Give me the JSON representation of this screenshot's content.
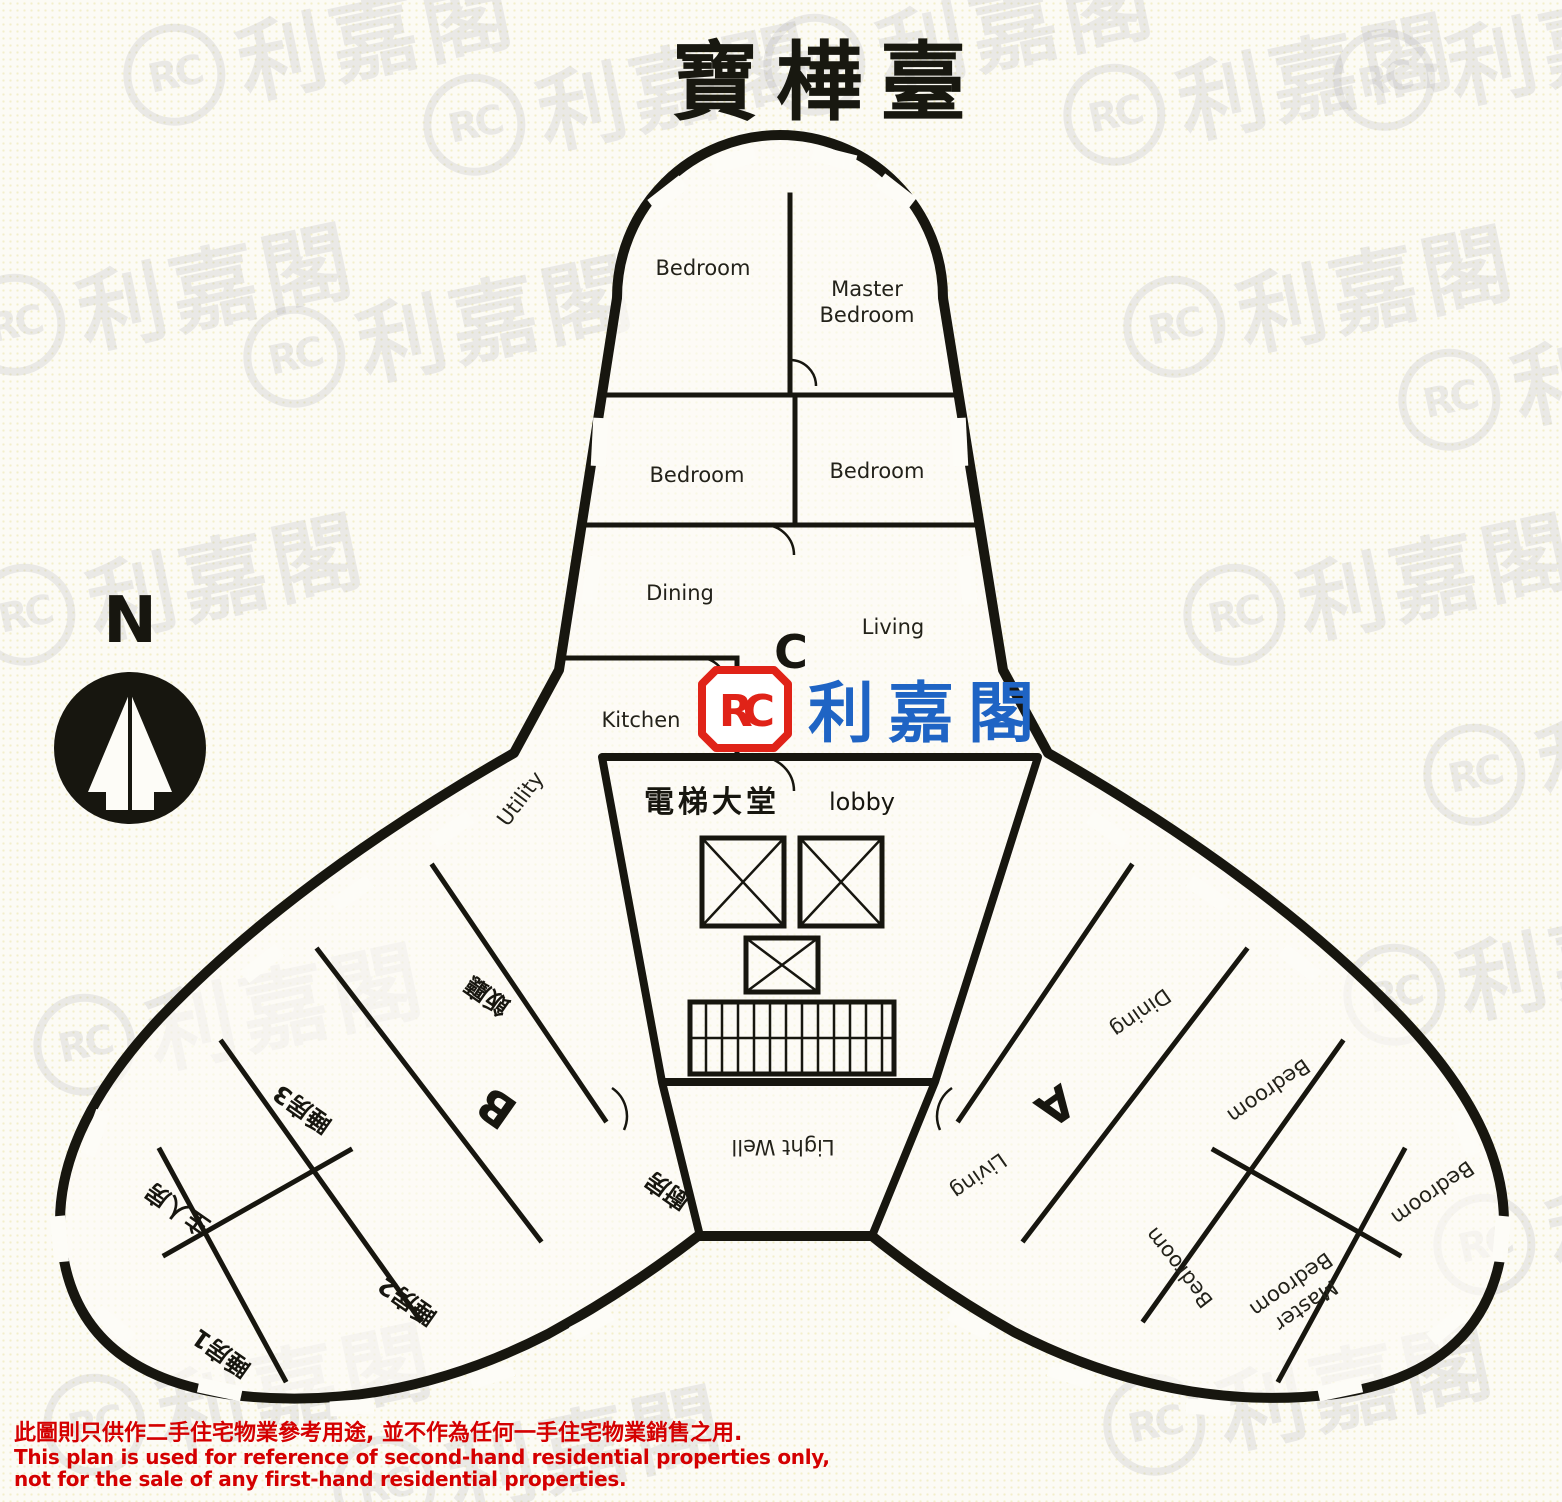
{
  "title": {
    "text": "寶樺臺"
  },
  "compass": {
    "label": "N"
  },
  "logo": {
    "monogram": "RC",
    "name": "利嘉閣"
  },
  "watermark": {
    "monogram": "RC",
    "text": "利嘉閣"
  },
  "core": {
    "lobby_zh": "電梯大堂",
    "lobby_en": "lobby",
    "light_well": "Light Well"
  },
  "unit_c": {
    "label": "C",
    "bedroom_top_left": "Bedroom",
    "master_line1": "Master",
    "master_line2": "Bedroom",
    "bedroom_mid_left": "Bedroom",
    "bedroom_mid_right": "Bedroom",
    "dining": "Dining",
    "living": "Living",
    "kitchen": "Kitchen",
    "utility": "Utility"
  },
  "unit_b": {
    "label": "B",
    "dining": "飯廳",
    "master": "主人房",
    "bedroom3": "睡房3",
    "bedroom2": "睡房2",
    "bedroom1": "睡房1",
    "kitchen": "廚房"
  },
  "unit_a": {
    "label": "A",
    "dining": "Dining",
    "living": "Living",
    "bedroom_top": "Bedroom",
    "bedroom_right": "Bedroom",
    "bedroom_left": "Bedroom",
    "master_line1": "Master",
    "master_line2": "Bedroom"
  },
  "disclaimer": {
    "line1_zh": "此圖則只供作二手住宅物業參考用途, 並不作為任何一手住宅物業銷售之用.",
    "line2_en": "This plan is used for reference of second-hand residential properties only,",
    "line3_en": " not for the sale of any first-hand residential properties."
  },
  "colors": {
    "ink": "#17160f",
    "disclaimer_red": "#d40000",
    "logo_red": "#e02318",
    "logo_blue": "#1f64c4"
  }
}
